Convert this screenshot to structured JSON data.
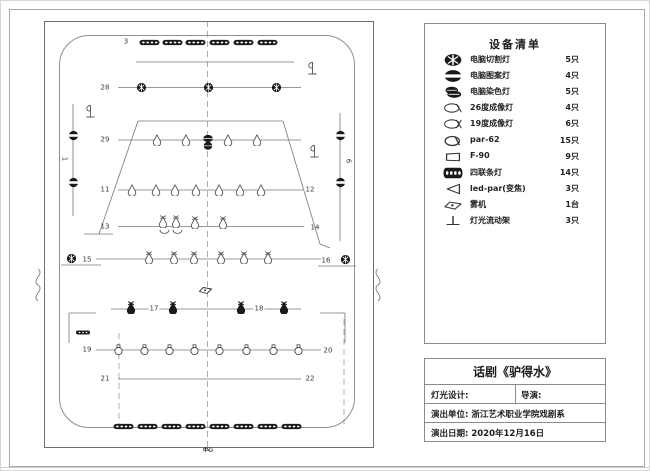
{
  "colors": {
    "line": "#777777",
    "dark": "#1a1a1a",
    "text": "#333333",
    "frame": "#6f6f6f"
  },
  "equipment_list": {
    "title": "设备清单",
    "rows": [
      {
        "symbol": "ccut",
        "name": "电脑切割灯",
        "count": "5只"
      },
      {
        "symbol": "cpat",
        "name": "电脑图案灯",
        "count": "4只"
      },
      {
        "symbol": "cdye",
        "name": "电脑染色灯",
        "count": "5只"
      },
      {
        "symbol": "prof26",
        "name": "26度成像灯",
        "count": "4只"
      },
      {
        "symbol": "prof19",
        "name": "19度成像灯",
        "count": "6只"
      },
      {
        "symbol": "par62",
        "name": "par-62",
        "count": "15只"
      },
      {
        "symbol": "f90",
        "name": "F-90",
        "count": "9只"
      },
      {
        "symbol": "strip",
        "name": "四联条灯",
        "count": "14只"
      },
      {
        "symbol": "ledpar",
        "name": "led-par(变焦)",
        "count": "3只"
      },
      {
        "symbol": "fog",
        "name": "雾机",
        "count": "1台"
      },
      {
        "symbol": "stand",
        "name": "灯光流动架",
        "count": "3只"
      }
    ]
  },
  "title_block": {
    "show_title": "话剧《驴得水》",
    "lighting_design_label": "灯光设计:",
    "director_label": "导演:",
    "unit_line": "演出单位: 浙江艺术职业学院戏剧系",
    "date_line": "演出日期: 2020年12月16日"
  },
  "plot": {
    "centerline_label": "中心",
    "solid_lines": [
      [
        135,
        61,
        293,
        61
      ],
      [
        117,
        86.5,
        300,
        86.5
      ],
      [
        117,
        139,
        300,
        139
      ],
      [
        137,
        120,
        282,
        120
      ],
      [
        137,
        120,
        98,
        233
      ],
      [
        282,
        120,
        319,
        243
      ],
      [
        83,
        233,
        112,
        233
      ],
      [
        319,
        243,
        329,
        247
      ],
      [
        117,
        189,
        302,
        189
      ],
      [
        117,
        225.5,
        303,
        225.5
      ],
      [
        95,
        258,
        320,
        258
      ],
      [
        60,
        264,
        100,
        264
      ],
      [
        317,
        265,
        355,
        265
      ],
      [
        110,
        308,
        300,
        308
      ],
      [
        95,
        312,
        68,
        312
      ],
      [
        68,
        312,
        68,
        342
      ],
      [
        319,
        312,
        344,
        312
      ],
      [
        344,
        312,
        344,
        342
      ],
      [
        95,
        349,
        320,
        349
      ],
      [
        117,
        378,
        300,
        378
      ],
      [
        72,
        103,
        72,
        215
      ],
      [
        339,
        112,
        339,
        240
      ]
    ],
    "dashed_lines": [
      [
        206.5,
        20,
        206.5,
        447
      ],
      [
        118,
        332,
        118,
        423
      ],
      [
        343,
        318,
        343,
        423
      ]
    ],
    "break_marks": [
      "M37,268 c7,5 -7,11 0,16 c7,5 -7,11 0,16",
      "M377,268 c-7,5 7,11 0,16 c-7,5 7,11 0,16"
    ],
    "labels": [
      {
        "t": "3",
        "x": 125,
        "y": 41
      },
      {
        "t": "28",
        "x": 104,
        "y": 87
      },
      {
        "t": "29",
        "x": 104,
        "y": 139
      },
      {
        "t": "1",
        "x": 63,
        "y": 158,
        "rot": true
      },
      {
        "t": "6",
        "x": 347,
        "y": 160,
        "rot": true
      },
      {
        "t": "11",
        "x": 104,
        "y": 189
      },
      {
        "t": "12",
        "x": 309,
        "y": 189
      },
      {
        "t": "13",
        "x": 104,
        "y": 226
      },
      {
        "t": "14",
        "x": 314,
        "y": 227
      },
      {
        "t": "15",
        "x": 86,
        "y": 259
      },
      {
        "t": "16",
        "x": 325,
        "y": 260
      },
      {
        "t": "17",
        "x": 153,
        "y": 308,
        "bg": true
      },
      {
        "t": "18",
        "x": 258,
        "y": 308,
        "bg": true
      },
      {
        "t": "19",
        "x": 86,
        "y": 349
      },
      {
        "t": "20",
        "x": 327,
        "y": 350
      },
      {
        "t": "21",
        "x": 104,
        "y": 378
      },
      {
        "t": "22",
        "x": 309,
        "y": 378
      }
    ],
    "fixtures": [
      {
        "t": "strip",
        "x": 148,
        "y": 41
      },
      {
        "t": "strip",
        "x": 171,
        "y": 41
      },
      {
        "t": "strip",
        "x": 194,
        "y": 41
      },
      {
        "t": "strip",
        "x": 218,
        "y": 41
      },
      {
        "t": "strip",
        "x": 242,
        "y": 41
      },
      {
        "t": "strip",
        "x": 266,
        "y": 41
      },
      {
        "t": "ccut",
        "x": 140,
        "y": 86
      },
      {
        "t": "ccut",
        "x": 207,
        "y": 86
      },
      {
        "t": "ccut",
        "x": 275,
        "y": 86
      },
      {
        "t": "cpat",
        "x": 72,
        "y": 134
      },
      {
        "t": "cpat",
        "x": 72,
        "y": 181
      },
      {
        "t": "cpat",
        "x": 339,
        "y": 134
      },
      {
        "t": "cpat",
        "x": 339,
        "y": 181
      },
      {
        "t": "flag",
        "x": 88,
        "y": 110
      },
      {
        "t": "flag",
        "x": 310,
        "y": 67
      },
      {
        "t": "flag",
        "x": 312,
        "y": 150
      },
      {
        "t": "tear",
        "x": 156,
        "y": 139
      },
      {
        "t": "tear",
        "x": 185,
        "y": 139
      },
      {
        "t": "cluster",
        "x": 207,
        "y": 141
      },
      {
        "t": "tear",
        "x": 227,
        "y": 139
      },
      {
        "t": "tear",
        "x": 256,
        "y": 139
      },
      {
        "t": "tear",
        "x": 131,
        "y": 189
      },
      {
        "t": "tear",
        "x": 155,
        "y": 189
      },
      {
        "t": "tear",
        "x": 174,
        "y": 189
      },
      {
        "t": "tear",
        "x": 195,
        "y": 189
      },
      {
        "t": "tear",
        "x": 218,
        "y": 189
      },
      {
        "t": "tear",
        "x": 239,
        "y": 189
      },
      {
        "t": "tear",
        "x": 260,
        "y": 189
      },
      {
        "t": "tearx",
        "x": 162,
        "y": 220
      },
      {
        "t": "tearx",
        "x": 175,
        "y": 220
      },
      {
        "t": "tearx",
        "x": 194,
        "y": 221
      },
      {
        "t": "tearx",
        "x": 222,
        "y": 221
      },
      {
        "t": "arcU",
        "x": 163,
        "y": 231
      },
      {
        "t": "arcU",
        "x": 176,
        "y": 231
      },
      {
        "t": "tearx",
        "x": 148,
        "y": 256
      },
      {
        "t": "tearx",
        "x": 173,
        "y": 256
      },
      {
        "t": "tearx",
        "x": 193,
        "y": 256
      },
      {
        "t": "tearx",
        "x": 220,
        "y": 256
      },
      {
        "t": "tearx",
        "x": 243,
        "y": 256
      },
      {
        "t": "tearx",
        "x": 267,
        "y": 256
      },
      {
        "t": "ccut",
        "x": 70,
        "y": 257
      },
      {
        "t": "ccut",
        "x": 344,
        "y": 258
      },
      {
        "t": "fog",
        "x": 204,
        "y": 289
      },
      {
        "t": "washx",
        "x": 130,
        "y": 306
      },
      {
        "t": "washx",
        "x": 172,
        "y": 306
      },
      {
        "t": "washx",
        "x": 240,
        "y": 306
      },
      {
        "t": "washx",
        "x": 283,
        "y": 306
      },
      {
        "t": "ministrip",
        "x": 82,
        "y": 331
      },
      {
        "t": "oval19",
        "x": 117,
        "y": 349
      },
      {
        "t": "oval19",
        "x": 143,
        "y": 349
      },
      {
        "t": "oval19",
        "x": 168,
        "y": 349
      },
      {
        "t": "oval19",
        "x": 193,
        "y": 349
      },
      {
        "t": "oval19",
        "x": 218,
        "y": 349
      },
      {
        "t": "oval19",
        "x": 245,
        "y": 349
      },
      {
        "t": "oval19",
        "x": 272,
        "y": 349
      },
      {
        "t": "oval19",
        "x": 297,
        "y": 349
      },
      {
        "t": "strip",
        "x": 122,
        "y": 425
      },
      {
        "t": "strip",
        "x": 146,
        "y": 425
      },
      {
        "t": "strip",
        "x": 170,
        "y": 425
      },
      {
        "t": "strip",
        "x": 194,
        "y": 425
      },
      {
        "t": "strip",
        "x": 218,
        "y": 425
      },
      {
        "t": "strip",
        "x": 242,
        "y": 425
      },
      {
        "t": "strip",
        "x": 266,
        "y": 425
      },
      {
        "t": "strip",
        "x": 290,
        "y": 425
      }
    ]
  }
}
